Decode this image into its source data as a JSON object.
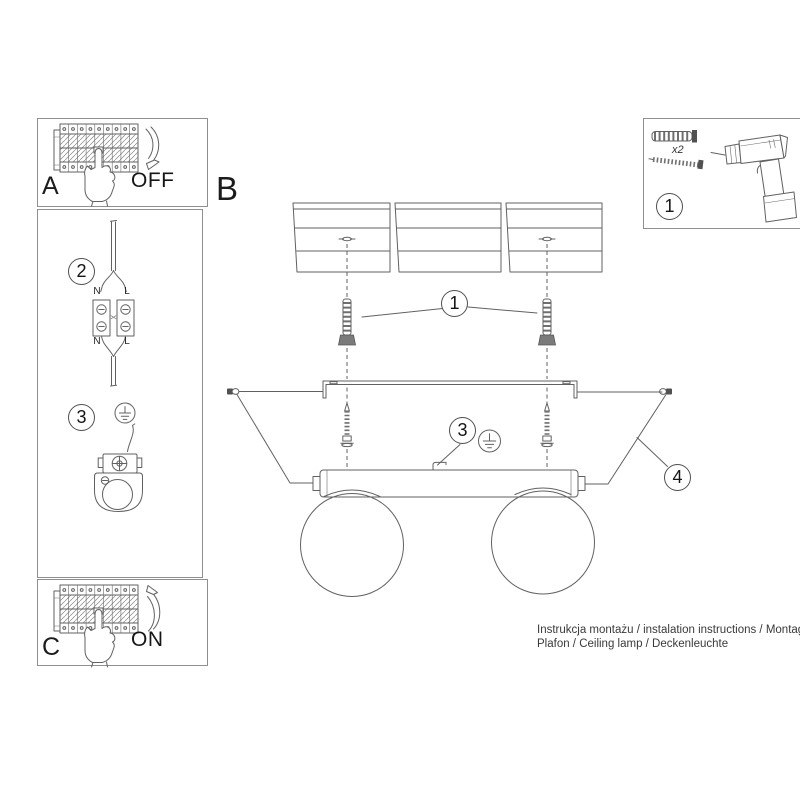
{
  "steps": {
    "breaker_off": {
      "letter": "A",
      "state": "OFF"
    },
    "main_section": {
      "letter": "B"
    },
    "breaker_on": {
      "letter": "C",
      "state": "ON"
    },
    "wiring": {
      "number": "2",
      "labels": {
        "top_n": "N",
        "top_l": "L",
        "bottom_n": "N",
        "bottom_l": "L"
      }
    },
    "grounding": {
      "number": "3"
    },
    "tools": {
      "number": "1",
      "anchor_quantity": "x2"
    }
  },
  "callouts": {
    "anchors": "1",
    "ground": "3",
    "side_screws": "4"
  },
  "footer": {
    "line1": "Instrukcja montażu / instalation instructions / Montageanleitung",
    "line2": "Plafon / Ceiling lamp / Deckenleuchte"
  },
  "colors": {
    "line": "#616161",
    "panel_border": "#8f8f8f",
    "text": "#1a1a1a",
    "footer_text": "#3a3a3a"
  }
}
